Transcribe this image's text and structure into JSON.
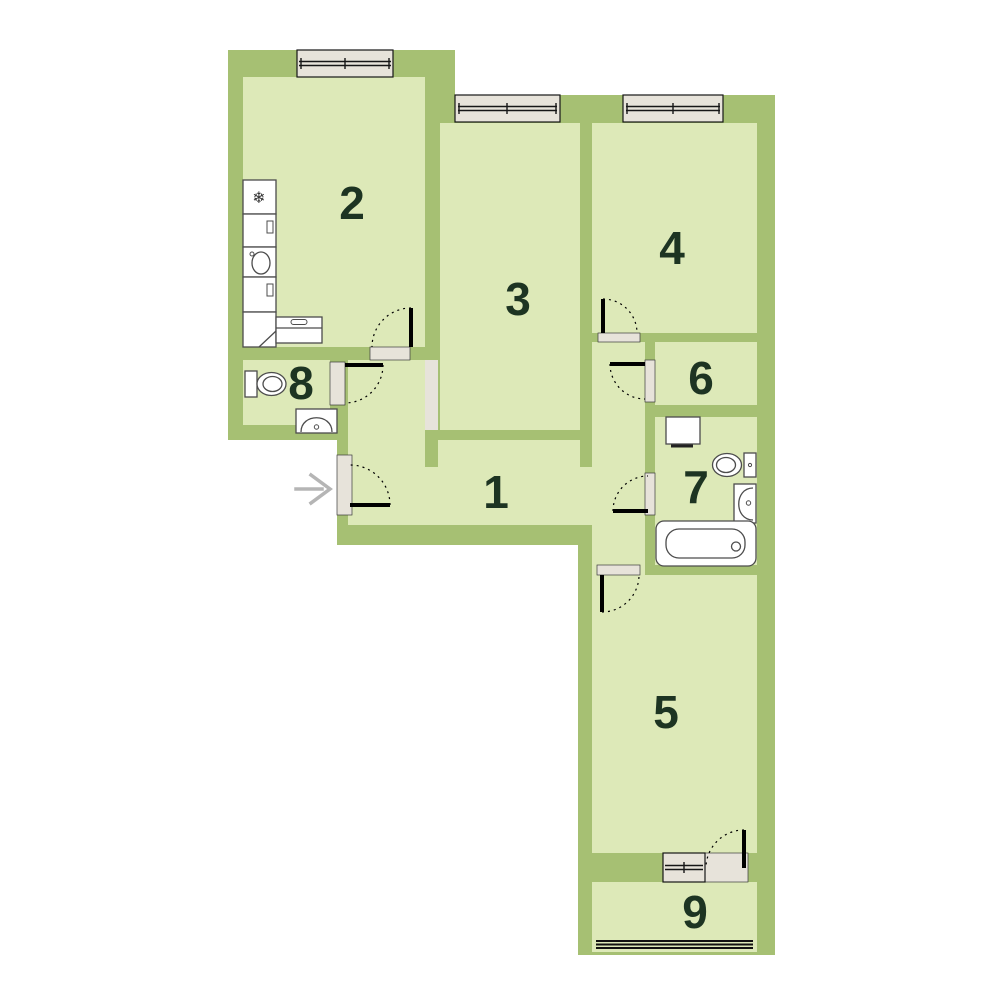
{
  "title": "apartment-floor-plan",
  "colors": {
    "page": "#ffffff",
    "wall": "#a6c073",
    "floor": "#dde9b8",
    "opening": "#e7e3da",
    "label": "#1d3422",
    "arrow": "#b5b5b5"
  },
  "rooms": [
    {
      "label": "1"
    },
    {
      "label": "2"
    },
    {
      "label": "3"
    },
    {
      "label": "4"
    },
    {
      "label": "5"
    },
    {
      "label": "6"
    },
    {
      "label": "7"
    },
    {
      "label": "8"
    },
    {
      "label": "9"
    }
  ],
  "kitchen": {
    "fridge_glyph": "❄"
  },
  "fixtures": [
    "fridge",
    "kitchen-cabinets",
    "kitchen-sink",
    "stove-bench",
    "toilet",
    "wash-basin",
    "washing-machine",
    "bathtub"
  ],
  "entrance": {
    "arrow_direction": "right"
  }
}
